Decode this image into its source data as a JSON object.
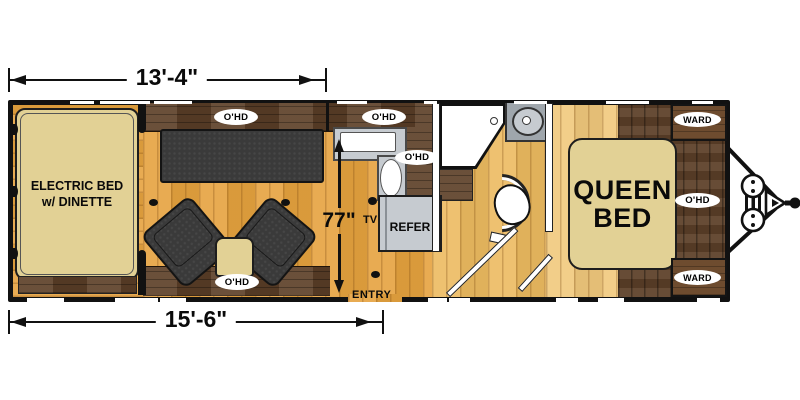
{
  "dimensions": {
    "width_top": "13'-4\"",
    "width_bottom": "15'-6\"",
    "interior": "77\""
  },
  "areas": {
    "electric_bed": {
      "line1": "ELECTRIC BED",
      "line2": "w/ DINETTE"
    },
    "queen_bed": {
      "line1": "QUEEN",
      "line2": "BED"
    }
  },
  "labels": {
    "overhead": "O'HD",
    "wardrobe": "WARD",
    "refrigerator": "REFER",
    "tv": "TV",
    "entry": "ENTRY"
  },
  "colors": {
    "floor_main": "#E5A23E",
    "floor_bath": "#ECBA60",
    "floor_bedroom": "#F0C87C",
    "cabinet_dark": "#5E4129",
    "counter_gray": "#C6CBD0",
    "furniture_tan": "#E2D195",
    "seat_dark": "#3A3A3A",
    "wall_black": "#111111"
  }
}
